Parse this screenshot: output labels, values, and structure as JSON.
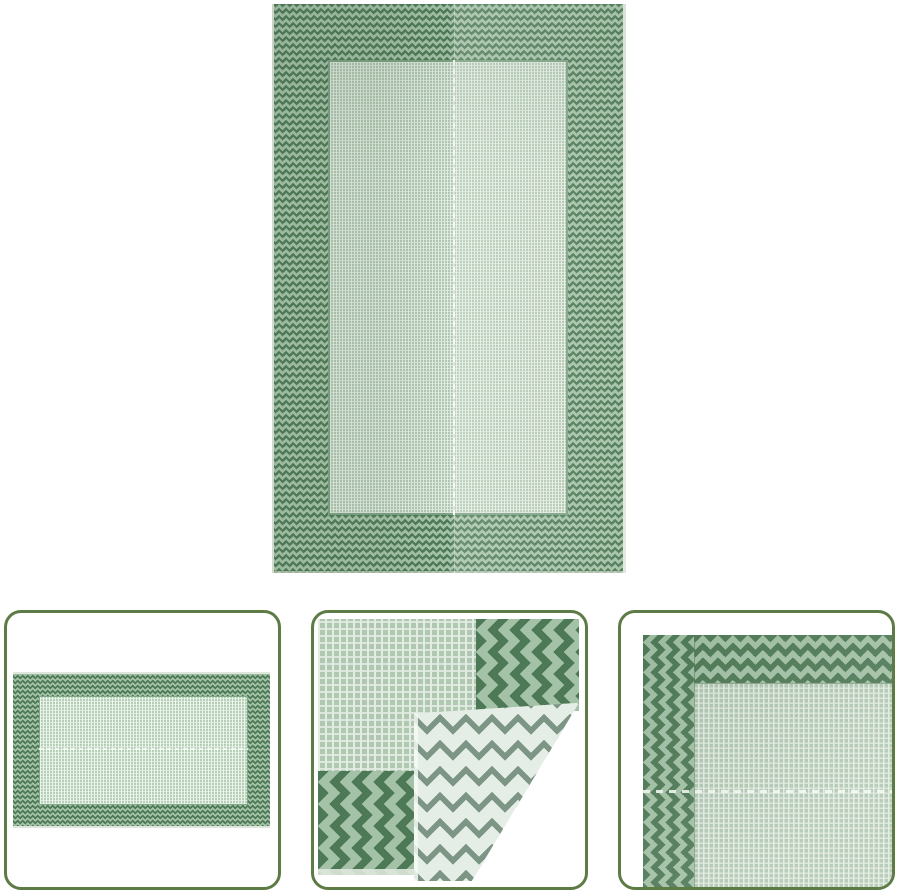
{
  "page": {
    "background": "#ffffff"
  },
  "product": {
    "main_image": {
      "name": "rug-front-full-view",
      "alt": "Green outdoor rug with dark chevron border and light woven center field, portrait view with center seam"
    },
    "thumbnails": [
      {
        "name": "rug-horizontal-full-view",
        "alt": "Full view of the green rug in landscape orientation"
      },
      {
        "name": "rug-folded-corner-detail",
        "alt": "Corner of rug folded over showing light reverse chevron weave"
      },
      {
        "name": "rug-border-corner-detail",
        "alt": "Close-up of rug corner with chevron border and woven field"
      }
    ]
  },
  "colors": {
    "page_bg": "#ffffff",
    "card_border": "#5d7c45",
    "chevron_dark": "#4e7956",
    "chevron_light": "#a3c2a7",
    "weave_base": "#b0c7b2",
    "weave_highlight": "#e3ece1",
    "field_outline": "#7ba183",
    "rug_edge": "#dfe7dc",
    "reverse_bg": "#e5eee6",
    "reverse_line": "#7c9584",
    "seam_dash": "#f5f9f4"
  }
}
